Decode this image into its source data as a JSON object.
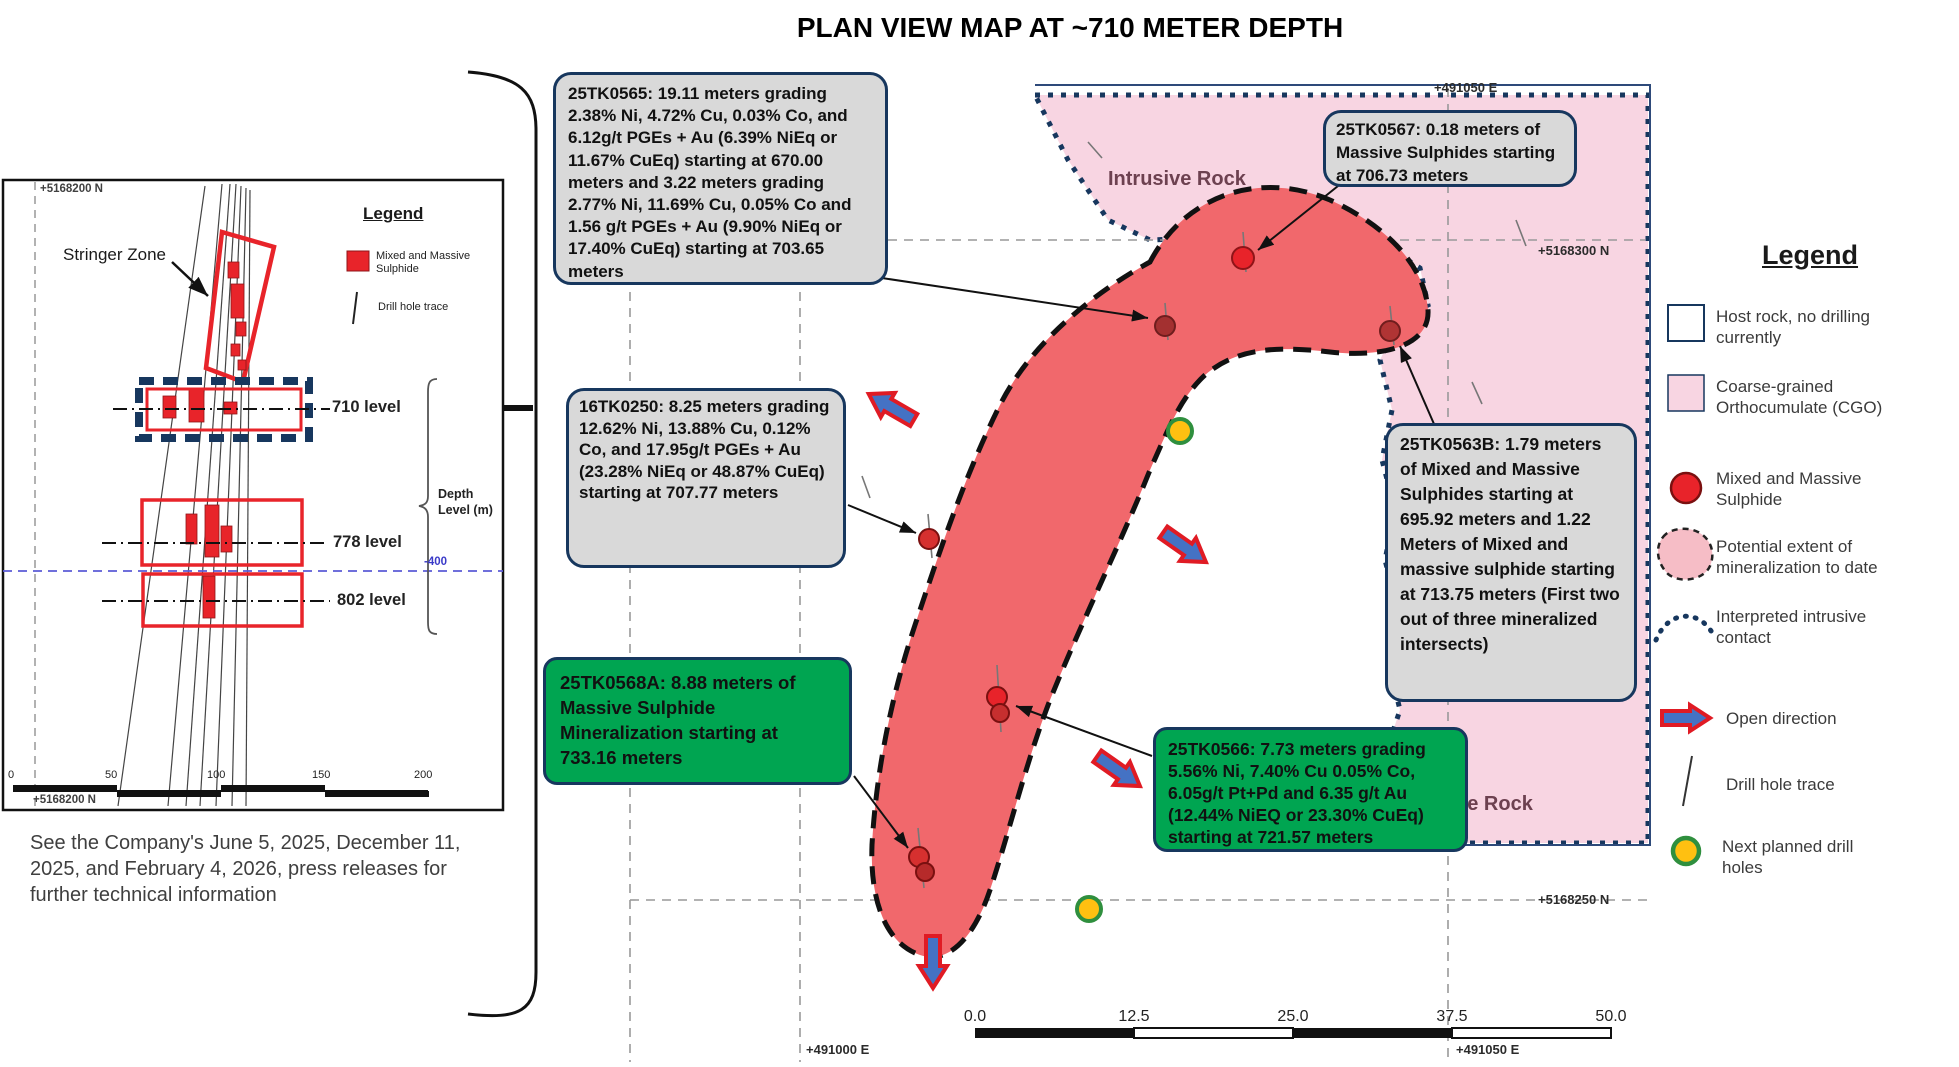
{
  "title": "PLAN VIEW MAP AT ~710 METER DEPTH",
  "caption": "See the Company's June 5, 2025, December 11, 2025, and February 4, 2026, press releases for further technical information",
  "inset": {
    "northing_top": "+5168200 N",
    "northing_bottom": "+5168200 N",
    "stringer_zone_label": "Stringer Zone",
    "legend_title": "Legend",
    "legend_items": [
      {
        "label": "Mixed and Massive Sulphide"
      },
      {
        "label": "Drill hole trace"
      }
    ],
    "levels": [
      {
        "label": "710 level"
      },
      {
        "label": "778 level"
      },
      {
        "label": "802 level"
      }
    ],
    "depth_axis_line1": "Depth",
    "depth_axis_line2": "Level (m)",
    "elevation_label": "-400",
    "scale_ticks": [
      "0",
      "50",
      "100",
      "150",
      "200"
    ]
  },
  "map": {
    "intrusive_rock_top": "Intrusive Rock",
    "intrusive_rock_right": "Intrusive Rock",
    "easting_top": "+491050 E",
    "easting_bottom_left": "+491000 E",
    "easting_bottom_right": "+491050 E",
    "northing_upper": "+5168300 N",
    "northing_lower": "+5168250 N",
    "scale_ticks": [
      "0.0",
      "12.5",
      "25.0",
      "37.5",
      "50.0"
    ],
    "callouts": {
      "h25TK0565": "25TK0565: 19.11 meters grading 2.38% Ni, 4.72% Cu, 0.03% Co, and 6.12g/t PGEs + Au (6.39% NiEq or 11.67% CuEq) starting at 670.00 meters  and 3.22 meters grading 2.77% Ni, 11.69% Cu, 0.05% Co and 1.56 g/t PGEs + Au (9.90% NiEq or 17.40% CuEq) starting at 703.65 meters",
      "h25TK0567": "25TK0567: 0.18 meters of Massive Sulphides starting at 706.73 meters",
      "h16TK0250": "16TK0250: 8.25 meters grading 12.62% Ni, 13.88% Cu, 0.12% Co, and 17.95g/t PGEs + Au (23.28% NiEq or 48.87% CuEq) starting at 707.77 meters",
      "h25TK0563B": "25TK0563B: 1.79 meters of Mixed and Massive Sulphides starting at 695.92 meters and 1.22 Meters of Mixed and massive sulphide starting at 713.75 meters (First two out of three mineralized intersects)",
      "h25TK0568A": "25TK0568A: 8.88 meters of Massive Sulphide Mineralization starting at 733.16 meters",
      "h25TK0566": "25TK0566: 7.73 meters grading 5.56% Ni, 7.40% Cu 0.05% Co, 6.05g/t Pt+Pd and 6.35 g/t Au (12.44% NiEQ or 23.30% CuEq) starting at 721.57 meters"
    }
  },
  "legend": {
    "title": "Legend",
    "items": [
      {
        "label": "Host rock, no drilling currently",
        "swatch": "host-rock-square"
      },
      {
        "label": "Coarse-grained Orthocumulate (CGO)",
        "swatch": "cgo-pink-square"
      },
      {
        "label": "Mixed and Massive Sulphide",
        "swatch": "red-circle"
      },
      {
        "label": "Potential extent of mineralization to date",
        "swatch": "pink-blob-dashed"
      },
      {
        "label": "Interpreted intrusive contact",
        "swatch": "dotted-curve"
      },
      {
        "label": "Open direction",
        "swatch": "red-blue-arrow"
      },
      {
        "label": "Drill hole trace",
        "swatch": "line"
      },
      {
        "label": "Next planned drill holes",
        "swatch": "yellow-circle-green-ring"
      }
    ]
  },
  "colors": {
    "callout_gray": "#d9d9d9",
    "callout_green": "#00a551",
    "navy_border": "#17375e",
    "pink_cgo": "#f8d5e2",
    "mineralization_red": "#f1686c",
    "sulphide_red": "#e8232a",
    "planned_yellow": "#ffc011",
    "planned_ring_green": "#2f8f3e"
  }
}
